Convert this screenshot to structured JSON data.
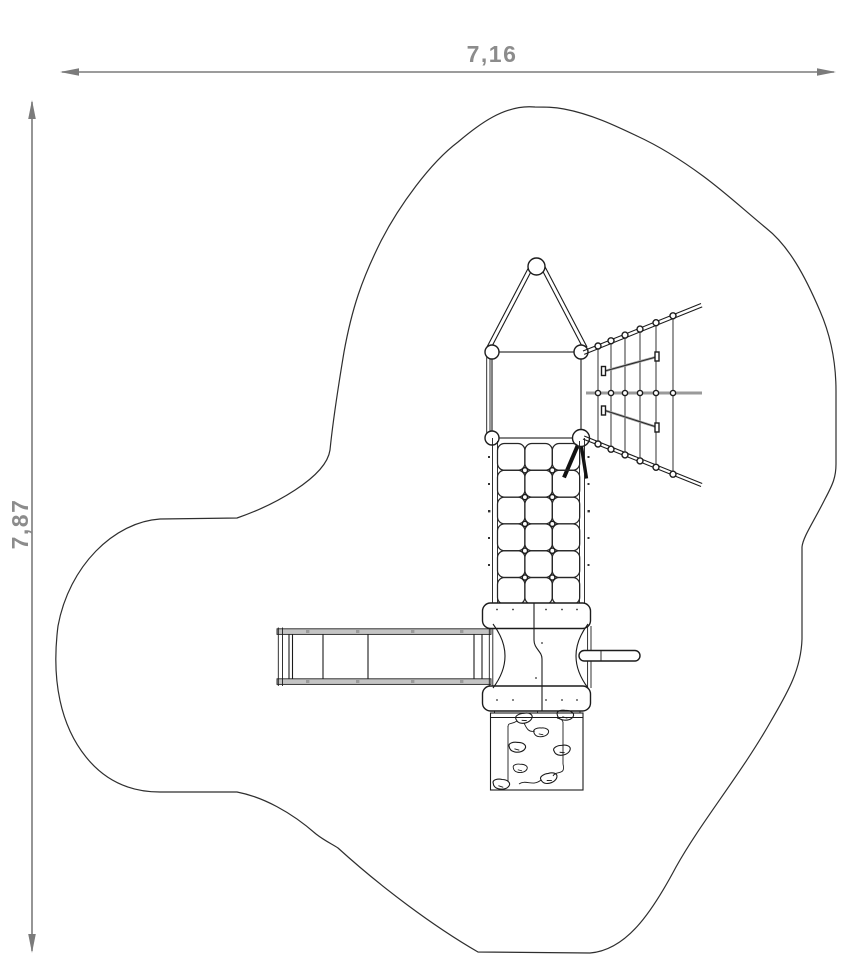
{
  "drawing": {
    "kind": "playground-equipment-plan-view",
    "dimensions": {
      "width_label": "7,16",
      "height_label": "7,87"
    },
    "colors": {
      "background": "#ffffff",
      "line": "#1c1c1c",
      "outline": "#2e2e2e",
      "dimension_line": "#7b7b7b",
      "dimension_text": "#8c8c8c",
      "rail_fill": "#c4c4c4",
      "net_bar": "#9a9a9a"
    },
    "components": [
      "safety-zone-outline",
      "tower-with-pitched-roof",
      "climbing-net-fan",
      "rope-grid-ladder",
      "platform-panels",
      "handrail-bar",
      "slide",
      "climbing-wall-with-rocks"
    ]
  }
}
